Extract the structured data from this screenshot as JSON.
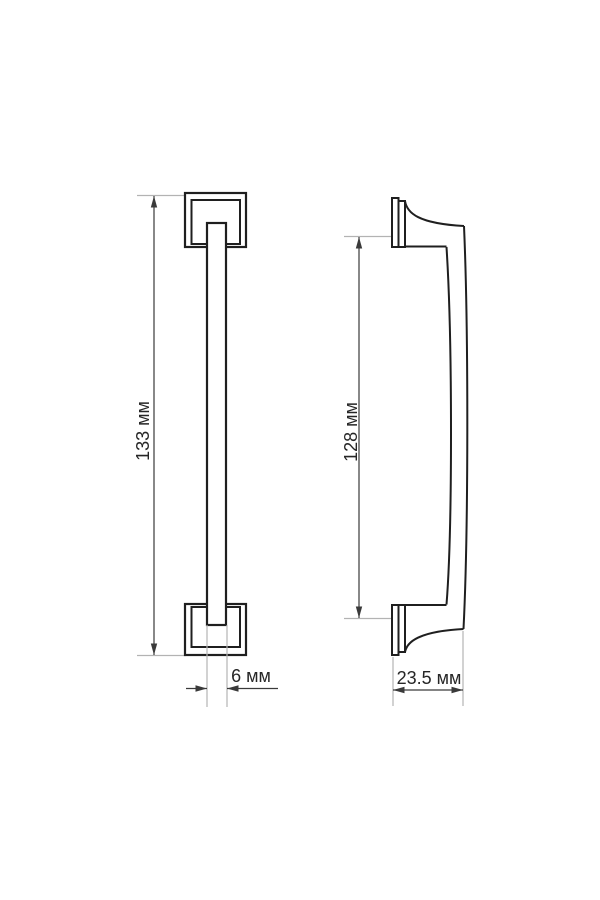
{
  "labels": {
    "front_overall_height": "133 мм",
    "front_bar_width": "6 мм",
    "side_mounting_span": "128 мм",
    "side_depth": "23.5 мм"
  },
  "dimensions_mm": {
    "front_overall_height": 133,
    "front_bar_width": 6,
    "side_mounting_span": 128,
    "side_depth": 23.5
  },
  "colors": {
    "outline": "#1f1f1f",
    "dim": "#3a3a3a",
    "ext": "#b3b3b3",
    "text": "#262626",
    "bg": "#ffffff"
  }
}
